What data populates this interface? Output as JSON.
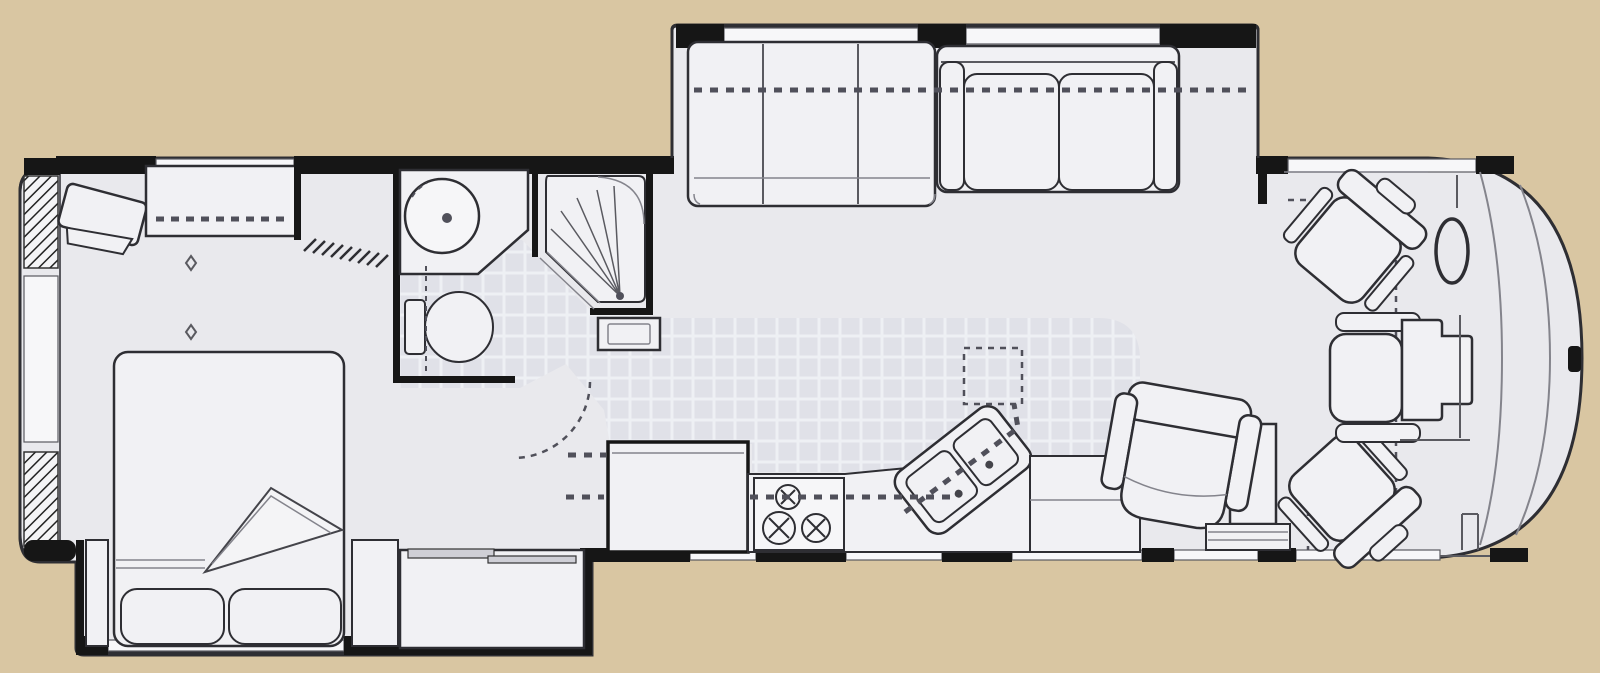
{
  "canvas": {
    "width": 1600,
    "height": 673
  },
  "image_kind": "rv-motorhome-floor-plan",
  "colors": {
    "tan": "#d9c6a2",
    "wall": "#161616",
    "interior": "#e9e9ed",
    "fur": "#f1f1f4",
    "glass": "#f7f7f9",
    "line": "#2e2e33",
    "line2": "#84848c",
    "line3": "#5a5a60",
    "dash": "#50505a",
    "tile": "#e0e1e8",
    "tileGrout": "#eef0f4"
  },
  "floorplan": {
    "orientation": "front-of-coach-right, rear-left",
    "regions": [
      "rear-bedroom",
      "bathroom",
      "hallway",
      "galley-kitchen",
      "living-area",
      "cockpit",
      "front-cap"
    ],
    "slideouts": [
      {
        "name": "sofa-slideout",
        "side": "top",
        "contents": [
          "jackknife-sofa",
          "three-cushion-sofa"
        ]
      },
      {
        "name": "bed-slideout",
        "side": "bottom",
        "contents": [
          "queen-bed",
          "nightstand-left",
          "nightstand-right",
          "wardrobe-sliding-doors"
        ]
      }
    ],
    "furniture": [
      "corner-tv",
      "dresser-with-mirror",
      "ceiling-vents",
      "queen-bed-with-folded-blanket",
      "pillows",
      "bath-vanity-round-sink",
      "toilet",
      "corner-shower",
      "shower-cabinet",
      "refrigerator",
      "range-three-burners",
      "double-sink-angled",
      "overhead-cabinet-dashed",
      "kitchen-counter",
      "raised-counter",
      "swivel-recliner",
      "side-cabinet",
      "step-cabinet",
      "driver-captain-chair-swiveled",
      "passenger-captain-chair-swiveled",
      "steering-wheel",
      "front-console-seat",
      "entry-steps",
      "windshield",
      "rear-wall-hatching",
      "windows"
    ]
  }
}
